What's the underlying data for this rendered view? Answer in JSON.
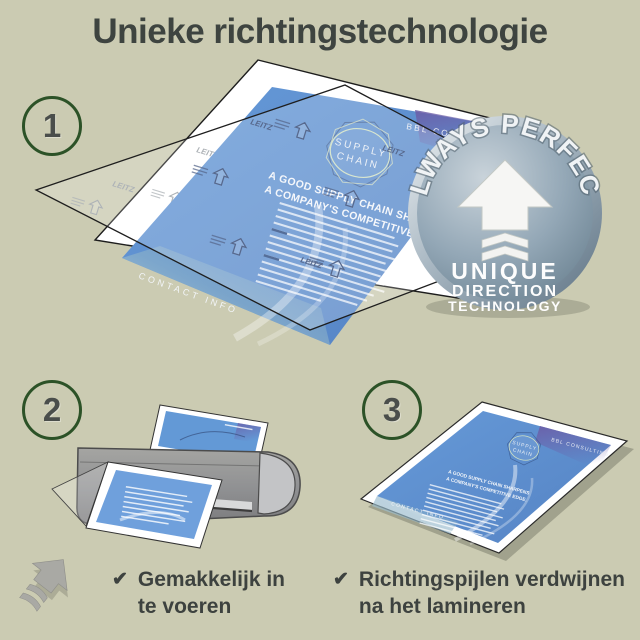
{
  "title": "Unieke richtingstechnologie",
  "steps": [
    {
      "number": "1"
    },
    {
      "number": "2"
    },
    {
      "number": "3"
    }
  ],
  "badge": {
    "arc_text": "ALWAYS PERFECT!",
    "line1": "UNIQUE",
    "line2": "DIRECTION",
    "line3": "TECHNOLOGY"
  },
  "brochure": {
    "brand": "BBL CONSULTING",
    "logo_line1": "SUPPLY",
    "logo_line2": "CHAIN",
    "headline_line1": "A GOOD SUPPLY CHAIN SHARPENS",
    "headline_line2": "A COMPANY'S COMPETITIVE EDGE.",
    "footer": "CONTACT INFO",
    "pouch_brand": "LEITZ"
  },
  "result_document": {
    "brand": "BBL CONSULTING",
    "logo_line1": "SUPPLY",
    "logo_line2": "CHAIN",
    "headline_line1": "A GOOD SUPPLY CHAIN SHARPENS",
    "headline_line2": "A COMPANY'S COMPETITIVE EDGE.",
    "footer": "CONTACT INFO"
  },
  "captions": [
    {
      "icon": "✔",
      "line1": "Gemakkelijk in",
      "line2": "te voeren"
    },
    {
      "icon": "✔",
      "line1": "Richtingspijlen verdwijnen",
      "line2": "na het lamineren"
    }
  ],
  "colors": {
    "background": "#cbcbb2",
    "title_text": "#3e4440",
    "step_ring": "#2c5227",
    "step_number": "#4a4e4b",
    "document_blue": "#5b8fd2",
    "accent_purple": "#6b5ca6",
    "accent_teal": "#7fae9e",
    "badge_metal": "#8ba0b0",
    "laminator_gray": "#909194"
  }
}
